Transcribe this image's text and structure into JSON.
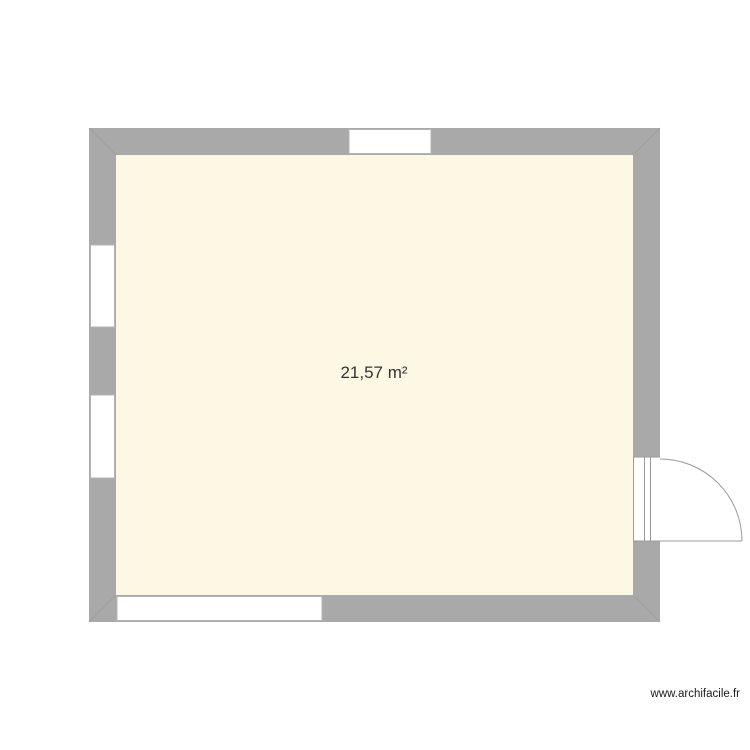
{
  "page": {
    "background": "#ffffff",
    "width": 750,
    "height": 750
  },
  "room": {
    "area_label": "21,57 m²"
  },
  "watermark": {
    "text": "www.archifacile.fr"
  },
  "colors": {
    "wall": "#a9a9a9",
    "floor": "#fdf8e3",
    "line": "#9b9b9b",
    "opening_fill": "#ffffff",
    "window_border": "#b5b5b5",
    "label_text": "#333333"
  },
  "plan": {
    "outer": {
      "x": 89,
      "y": 128,
      "w": 571,
      "h": 494
    },
    "wall_thickness": 27,
    "windows": [
      {
        "id": "window-top",
        "side": "top",
        "offset": 349,
        "length": 82
      },
      {
        "id": "window-left-upper",
        "side": "left",
        "offset": 245,
        "length": 82
      },
      {
        "id": "window-left-lower",
        "side": "left",
        "offset": 395,
        "length": 83
      },
      {
        "id": "window-bottom",
        "side": "bottom",
        "offset": 117,
        "length": 205
      }
    ],
    "door": {
      "id": "door-right",
      "side": "right",
      "offset": 457,
      "length": 84,
      "swing": "outward-down"
    }
  }
}
